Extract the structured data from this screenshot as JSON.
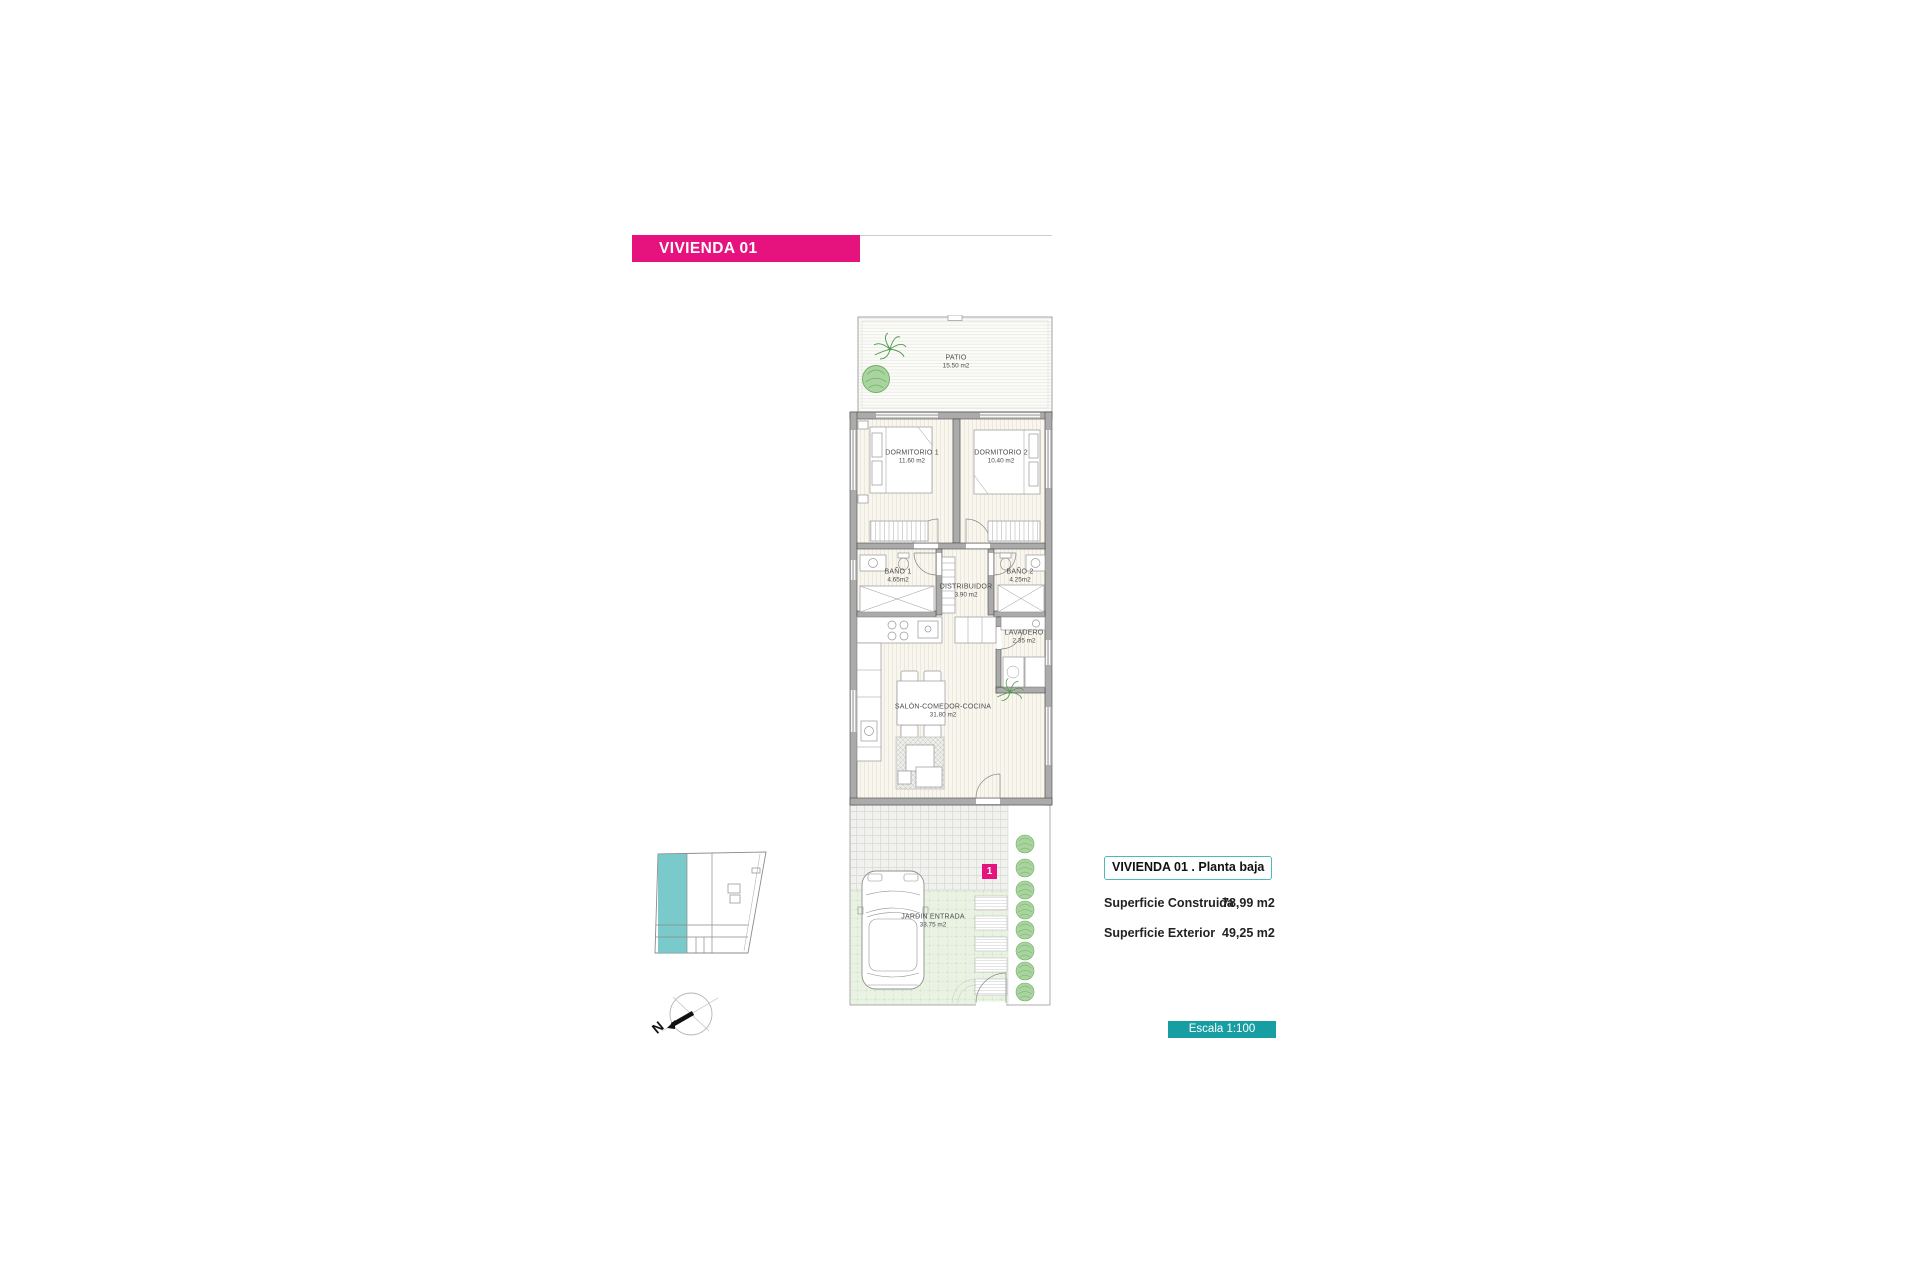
{
  "header": {
    "title": "VIVIENDA 01"
  },
  "plan": {
    "rooms": [
      {
        "name": "PATIO",
        "area": "15.50 m2"
      },
      {
        "name": "DORMITORIO 1",
        "area": "11.60 m2"
      },
      {
        "name": "DORMITORIO 2",
        "area": "10.40 m2"
      },
      {
        "name": "BAÑO 1",
        "area": "4.65m2"
      },
      {
        "name": "BAÑO 2",
        "area": "4.25m2"
      },
      {
        "name": "DISTRIBUIDOR",
        "area": "3.90 m2"
      },
      {
        "name": "LAVADERO",
        "area": "2.35 m2"
      },
      {
        "name": "SALÓN-COMEDOR-COCINA",
        "area": "31.80 m2"
      },
      {
        "name": "JARDIN ENTRADA",
        "area": "33.75 m2"
      }
    ],
    "unit_marker": "1"
  },
  "info_panel": {
    "title": "VIVIENDA 01 .  Planta baja",
    "rows": [
      {
        "label": "Superficie Construida",
        "value": "78,99 m2"
      },
      {
        "label": "Superficie Exterior",
        "value": "49,25 m2"
      }
    ]
  },
  "scale_box": {
    "label": "Escala 1:100"
  },
  "compass": {
    "label": "N"
  },
  "colors": {
    "accent_pink": "#e6137e",
    "teal": "#169ea2",
    "teal_border": "#4cbabc",
    "keyplan_highlight": "#63c1c3",
    "wall_gray": "#ababab",
    "plant_green": "#6fae63"
  }
}
